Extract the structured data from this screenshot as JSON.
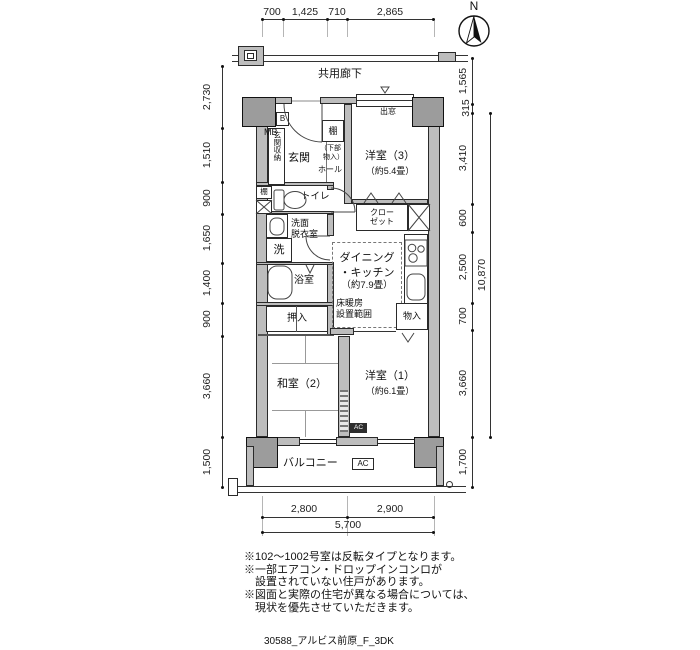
{
  "compass": {
    "north_label": "N"
  },
  "corridor": {
    "label": "共用廊下"
  },
  "plan": {
    "entrance": {
      "label": "玄関",
      "storage": "玄関収納",
      "mb": "MB",
      "b": "B"
    },
    "hall": {
      "label": "ホール",
      "shelf": "棚",
      "shelf_note1": "（下部",
      "shelf_note2": "物入）"
    },
    "toilet": {
      "label": "トイレ",
      "shelf": "棚"
    },
    "washroom": {
      "line1": "洗面",
      "line2": "脱衣室",
      "washer": "洗"
    },
    "bath": {
      "label": "浴室"
    },
    "oshiire": {
      "label": "押入"
    },
    "dk": {
      "line1": "ダイニング",
      "line2": "・キッチン",
      "line3": "（約7.9畳）",
      "heat1": "床暖房",
      "heat2": "設置範囲"
    },
    "closet": {
      "line1": "クロー",
      "line2": "ゼット"
    },
    "monoire": {
      "label": "物入"
    },
    "west_room3": {
      "line1": "洋室（3）",
      "line2": "（約5.4畳）",
      "bay": "出窓"
    },
    "washitsu": {
      "label": "和室（2）"
    },
    "west_room1": {
      "line1": "洋室（1）",
      "line2": "（約6.1畳）",
      "ac": "AC"
    },
    "balcony": {
      "label": "バルコニー",
      "ac": "AC"
    }
  },
  "dimensions": {
    "top": [
      "700",
      "1,425",
      "710",
      "2,865"
    ],
    "left": [
      "2,730",
      "1,510",
      "900",
      "1,650",
      "1,400",
      "900",
      "3,660",
      "1,500"
    ],
    "right": [
      "1,565",
      "315",
      "3,410",
      "600",
      "2,500",
      "700",
      "3,660",
      "1,700"
    ],
    "right_total": "10,870",
    "bottom": [
      "2,800",
      "2,900"
    ],
    "bottom_total": "5,700"
  },
  "notes": {
    "line1": "※102～1002号室は反転タイプとなります。",
    "line2": "※一部エアコン・ドロップインコンロが",
    "line3": "設置されていない住戸があります。",
    "line4": "※図面と実際の住宅が異なる場合については、",
    "line5": "現状を優先させていただきます。"
  },
  "footer": "30588_アルビス前原_F_3DK"
}
